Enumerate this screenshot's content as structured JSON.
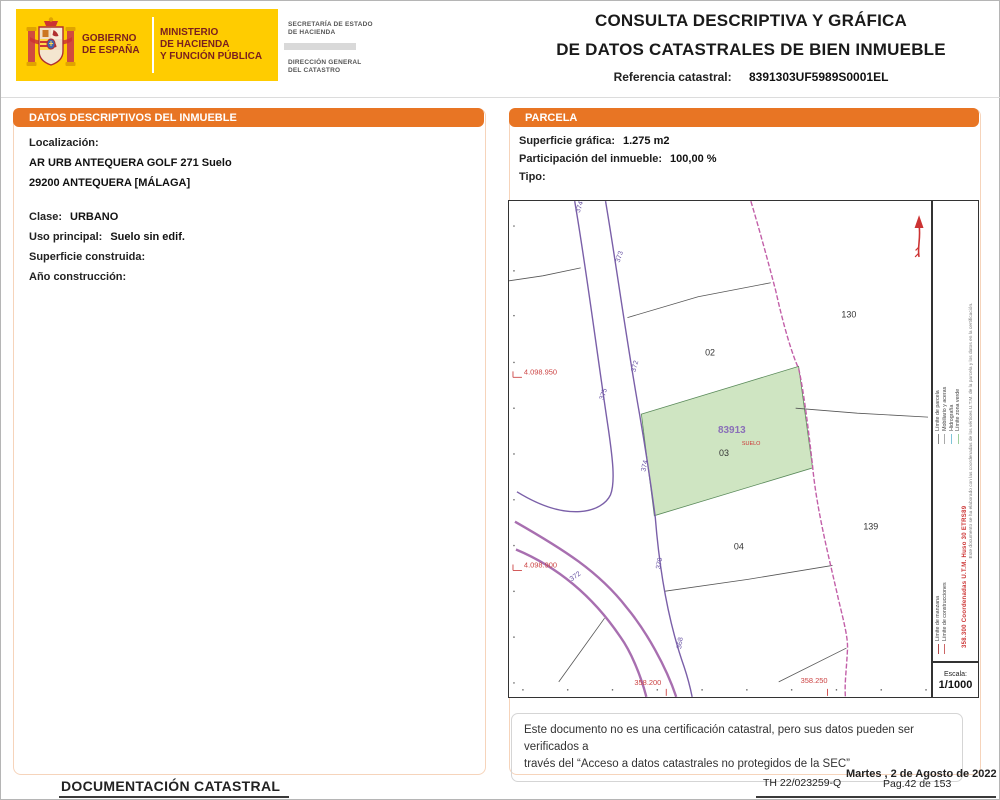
{
  "header": {
    "logo": {
      "gobierno_line1": "GOBIERNO",
      "gobierno_line2": "DE ESPAÑA",
      "ministerio_line1": "MINISTERIO",
      "ministerio_line2": "DE HACIENDA",
      "ministerio_line3": "Y FUNCIÓN PÚBLICA"
    },
    "secretaria_line1": "SECRETARÍA DE ESTADO",
    "secretaria_line2": "DE HACIENDA",
    "direccion_line1": "DIRECCIÓN GENERAL",
    "direccion_line2": "DEL CATASTRO",
    "title_line1": "CONSULTA DESCRIPTIVA Y GRÁFICA",
    "title_line2": "DE DATOS CATASTRALES DE BIEN INMUEBLE",
    "ref_label": "Referencia catastral:",
    "ref_value": "8391303UF5989S0001EL"
  },
  "left_panel": {
    "title": "DATOS DESCRIPTIVOS DEL INMUEBLE",
    "localizacion_label": "Localización:",
    "localizacion_line1": "AR URB ANTEQUERA GOLF 271 Suelo",
    "localizacion_line2": "29200 ANTEQUERA [MÁLAGA]",
    "clase_label": "Clase:",
    "clase_value": "URBANO",
    "uso_label": "Uso principal:",
    "uso_value": "Suelo sin edif.",
    "superficie_label": "Superficie construida:",
    "superficie_value": "",
    "anio_label": "Año construcción:",
    "anio_value": ""
  },
  "parcela_panel": {
    "title": "PARCELA",
    "superficie_label": "Superficie gráfica:",
    "superficie_value": "1.275 m2",
    "participacion_label": "Participación del inmueble:",
    "participacion_value": "100,00 %",
    "tipo_label": "Tipo:",
    "tipo_value": ""
  },
  "map": {
    "parcels": [
      "02",
      "130",
      "04",
      "139"
    ],
    "highlight": {
      "id": "83913",
      "type": "SUELO",
      "number": "03"
    },
    "road_labels": [
      "374",
      "373",
      "372",
      "375",
      "374",
      "372",
      "370",
      "368"
    ],
    "coords": [
      "4.098.950",
      "4.098.900",
      "358.200",
      "358.250"
    ],
    "legend": {
      "items": [
        {
          "label": "Límite de manzana",
          "color": "#b04a4a"
        },
        {
          "label": "Límite de parcela",
          "color": "#888888"
        },
        {
          "label": "Límite de construcciones",
          "color": "#cc6666"
        },
        {
          "label": "Mobiliario y aceras",
          "color": "#aaaaaa"
        },
        {
          "label": "Hidrografía",
          "color": "#7fc4d8"
        },
        {
          "label": "Límite zona verde",
          "color": "#9ecf9e"
        }
      ],
      "coords_text": "358.300 Coordenadas U.T.M. Huso 30 ETRS89",
      "disclaimer": "Este documento se ha elaborado con las coordenadas de los vértices U.T.M. de la parcela y los datos en la certificación.",
      "escala_label": "Escala:",
      "escala_value": "1/1000"
    }
  },
  "note": {
    "line1": "Este documento no es una certificación catastral, pero sus datos pueden ser verificados a",
    "line2": "través del “Acceso a datos catastrales no protegidos de la SEC”"
  },
  "footer": {
    "left": "DOCUMENTACIÓN CATASTRAL",
    "date": "Martes , 2 de Agosto de 2022",
    "ref": "TH 22/023259-Q",
    "page": "Pag.42 de 153"
  },
  "colors": {
    "accent_orange": "#e87524",
    "logo_yellow": "#ffcc00",
    "logo_text_red": "#7a1f1f",
    "parcel_green": "#cfe5c2",
    "road_purple": "#7a5fa8",
    "boundary_magenta": "#c25fa8",
    "coord_red": "#cc3333"
  }
}
